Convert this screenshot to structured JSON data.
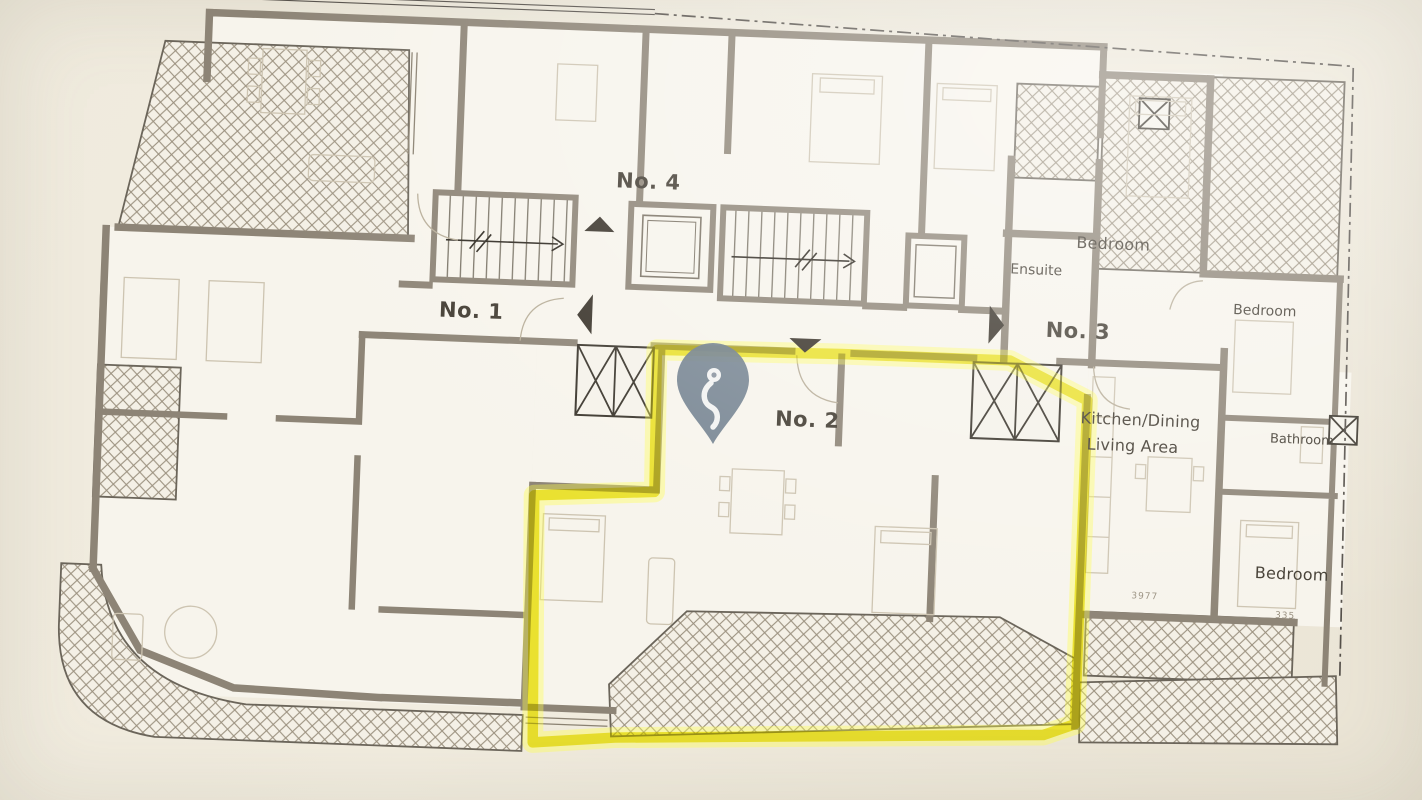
{
  "units": {
    "no1": "No. 1",
    "no2": "No. 2",
    "no3": "No. 3",
    "no4": "No. 4"
  },
  "rooms": {
    "bedroom_top": "Bedroom",
    "ensuite": "Ensuite",
    "bedroom_right": "Bedroom",
    "kitchen_line1": "Kitchen/Dining",
    "kitchen_line2": "Living Area",
    "bathroom": "Bathroom",
    "bedroom_bottom": "Bedroom"
  },
  "dimensions": {
    "dim1": "3977",
    "dim2": "335"
  },
  "highlight": {
    "unit": "No. 2",
    "color": "#efe73a",
    "glow_color": "#ffff4a"
  },
  "marker": {
    "type": "map-pin",
    "color": "#6f7e8d"
  },
  "colors": {
    "paper": "#efeadd",
    "room_fill": "#f7f4ec",
    "wall": "#8d8476",
    "hatch_line": "#9b917f",
    "ink": "#423c32",
    "arrow": "#3a342b"
  }
}
